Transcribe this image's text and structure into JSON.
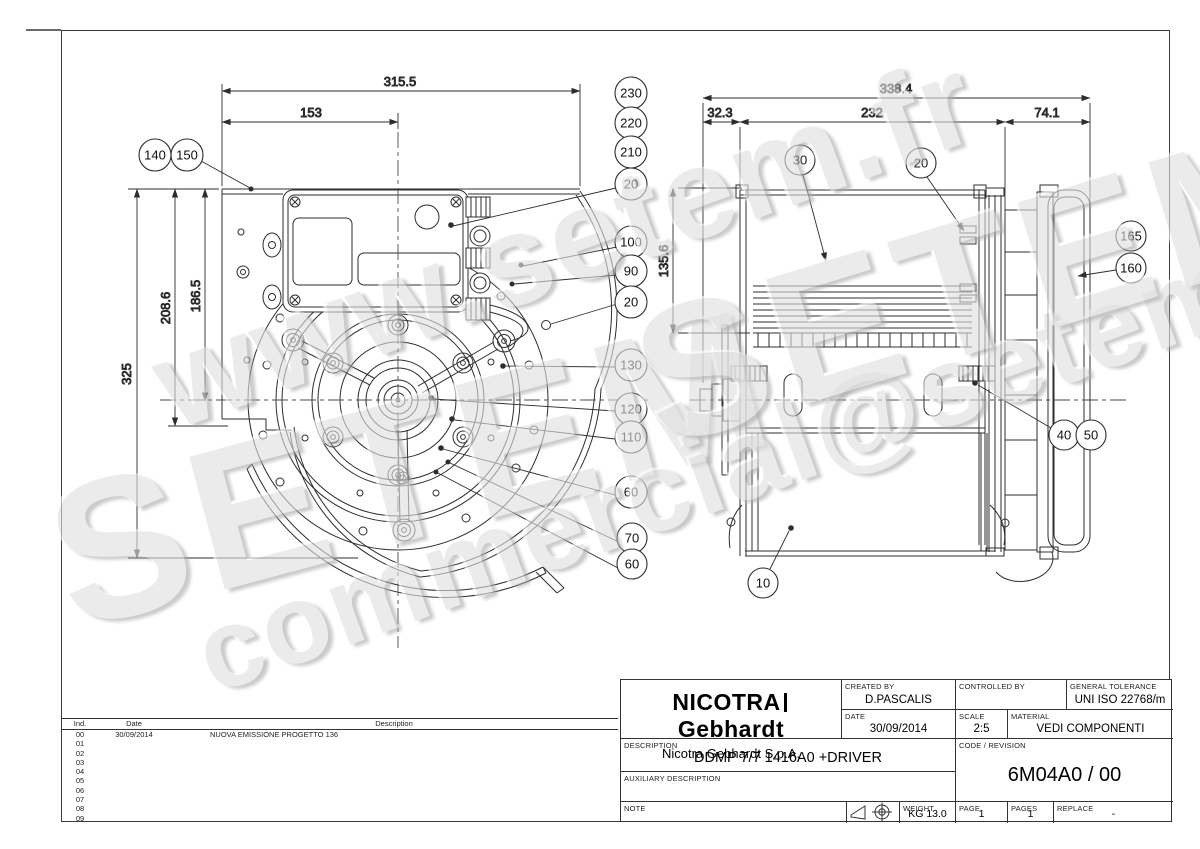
{
  "watermark": {
    "site": "www.setem.fr",
    "brand": "SETEM",
    "email": "commercial@setem.fr"
  },
  "front_view": {
    "dims": {
      "overall_width": "315.5",
      "to_centerline_x": "153",
      "overall_height": "325",
      "below_center": "208.6",
      "to_centerline_y": "186.5"
    },
    "balloons": [
      "140",
      "150",
      "230",
      "220",
      "210",
      "20",
      "100",
      "90",
      "20",
      "130",
      "120",
      "110",
      "60",
      "70",
      "60"
    ]
  },
  "side_view": {
    "dims": {
      "overall_length": "338.4",
      "left_offset": "32.3",
      "casing_width": "232",
      "driver_length": "74.1",
      "height_to_center": "135.6"
    },
    "balloons": [
      "30",
      "20",
      "165",
      "160",
      "40",
      "50",
      "10"
    ]
  },
  "revision_table": {
    "headers": {
      "ind": "Ind.",
      "date": "Date",
      "description": "Description"
    },
    "rows": [
      {
        "ind": "00",
        "date": "30/09/2014",
        "description": "NUOVA EMISSIONE PROGETTO 136"
      },
      {
        "ind": "01",
        "date": "",
        "description": ""
      },
      {
        "ind": "02",
        "date": "",
        "description": ""
      },
      {
        "ind": "03",
        "date": "",
        "description": ""
      },
      {
        "ind": "04",
        "date": "",
        "description": ""
      },
      {
        "ind": "05",
        "date": "",
        "description": ""
      },
      {
        "ind": "06",
        "date": "",
        "description": ""
      },
      {
        "ind": "07",
        "date": "",
        "description": ""
      },
      {
        "ind": "08",
        "date": "",
        "description": ""
      },
      {
        "ind": "09",
        "date": "",
        "description": ""
      }
    ]
  },
  "title_block": {
    "brand": {
      "part1": "NICOTRA",
      "part2": "Gebhardt",
      "company": "Nicotra Gebhardt S.p.A."
    },
    "labels": {
      "created_by": "CREATED BY",
      "controlled_by": "CONTROLLED BY",
      "general_tolerance": "GENERAL TOLERANCE",
      "date": "DATE",
      "scale": "SCALE",
      "material": "MATERIAL",
      "description": "DESCRIPTION",
      "auxiliary_description": "AUXILIARY DESCRIPTION",
      "code_revision": "CODE / REVISION",
      "note": "NOTE",
      "weight": "WEIGHT",
      "page": "PAGE",
      "pages": "PAGES",
      "replace": "REPLACE"
    },
    "values": {
      "created_by": "D.PASCALIS",
      "controlled_by": "",
      "general_tolerance": "UNI ISO 22768/m",
      "date": "30/09/2014",
      "scale": "2:5",
      "material": "VEDI COMPONENTI",
      "description": "DDMP 7/7 1416A0 +DRIVER",
      "auxiliary_description": "",
      "code_revision": "6M04A0 / 00",
      "note": "",
      "weight": "KG 13.0",
      "page": "1",
      "pages": "1",
      "replace": "-"
    },
    "icons": {
      "projection_cone": "first-angle-projection-cone-icon",
      "projection_target": "projection-target-crosshair-icon"
    }
  },
  "colors": {
    "line": "#2d2d2d",
    "watermark": "#e0e0e0",
    "background": "#ffffff"
  }
}
